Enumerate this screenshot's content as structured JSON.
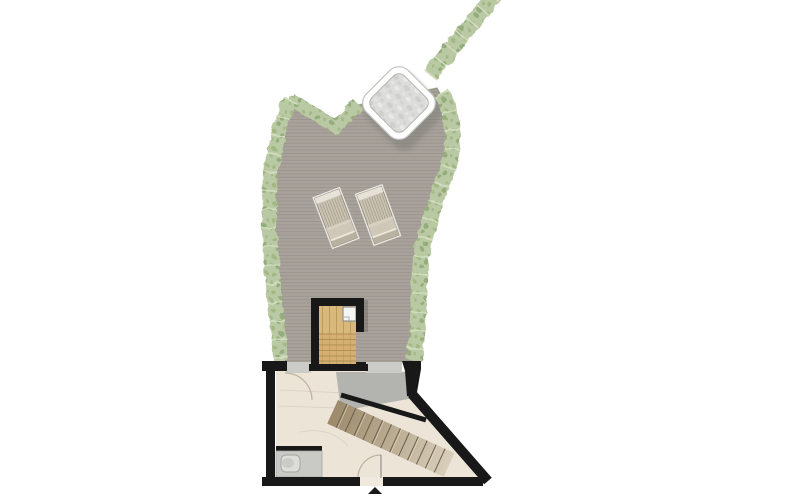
{
  "meta": {
    "kind": "architectural-floor-plan",
    "view": "top-down roof terrace with lower room",
    "canvas": {
      "width": 800,
      "height": 500
    }
  },
  "colors": {
    "deck_base": "#a8a29b",
    "deck_line": "#948f88",
    "hedge_base": "#b9c9a3",
    "hedge_spot1": "#9cb57e",
    "hedge_spot2": "#8ca671",
    "hedge_tick": "#d5dfc2",
    "hedge_edge": "#74875c",
    "wall": "#181818",
    "wood_base": "#d9b87c",
    "wood_line": "#b08f54",
    "floor_base": "#ece4d7",
    "floor_seam": "#d9cfc0",
    "landing": "#b3b3b0",
    "opening": "#cbcbc8",
    "stair_start": "#9c8a6a",
    "stair_end": "#d8cebb",
    "stair_tread_line": "#6b5f4c",
    "stair_highlight": "#e6dcc8",
    "counter": "#c9c9c6",
    "counter_edge": "#a5a5a2",
    "sink": "#dcdcd9",
    "tub_border": "#ffffff",
    "tub_outline": "#c3c3c0",
    "tub_water": "#dcdcda",
    "shadow": "#6f6f6b",
    "chair_body": "#cac2b2",
    "chair_head": "#e7e2d7",
    "chair_slat": "#a09884",
    "chair_edge": "#8d8473",
    "chair_foot": "#b9b1a0",
    "arc": "#bfb29d"
  },
  "features": {
    "hedge_border": "planted hedge strip around terrace",
    "terrace_deck": "plank decking",
    "hot_tub": "square hot tub, rotated, white rim",
    "sun_loungers": {
      "count": 2
    },
    "stair_room": "enclosed stair with wooden treads",
    "lower_room": "walled room with diagonal wall",
    "interior_staircase": "diagonal staircase",
    "counter_with_basin": "low counter with basin, bottom-left",
    "entrance_marker": "triangle arrow at bottom opening"
  }
}
